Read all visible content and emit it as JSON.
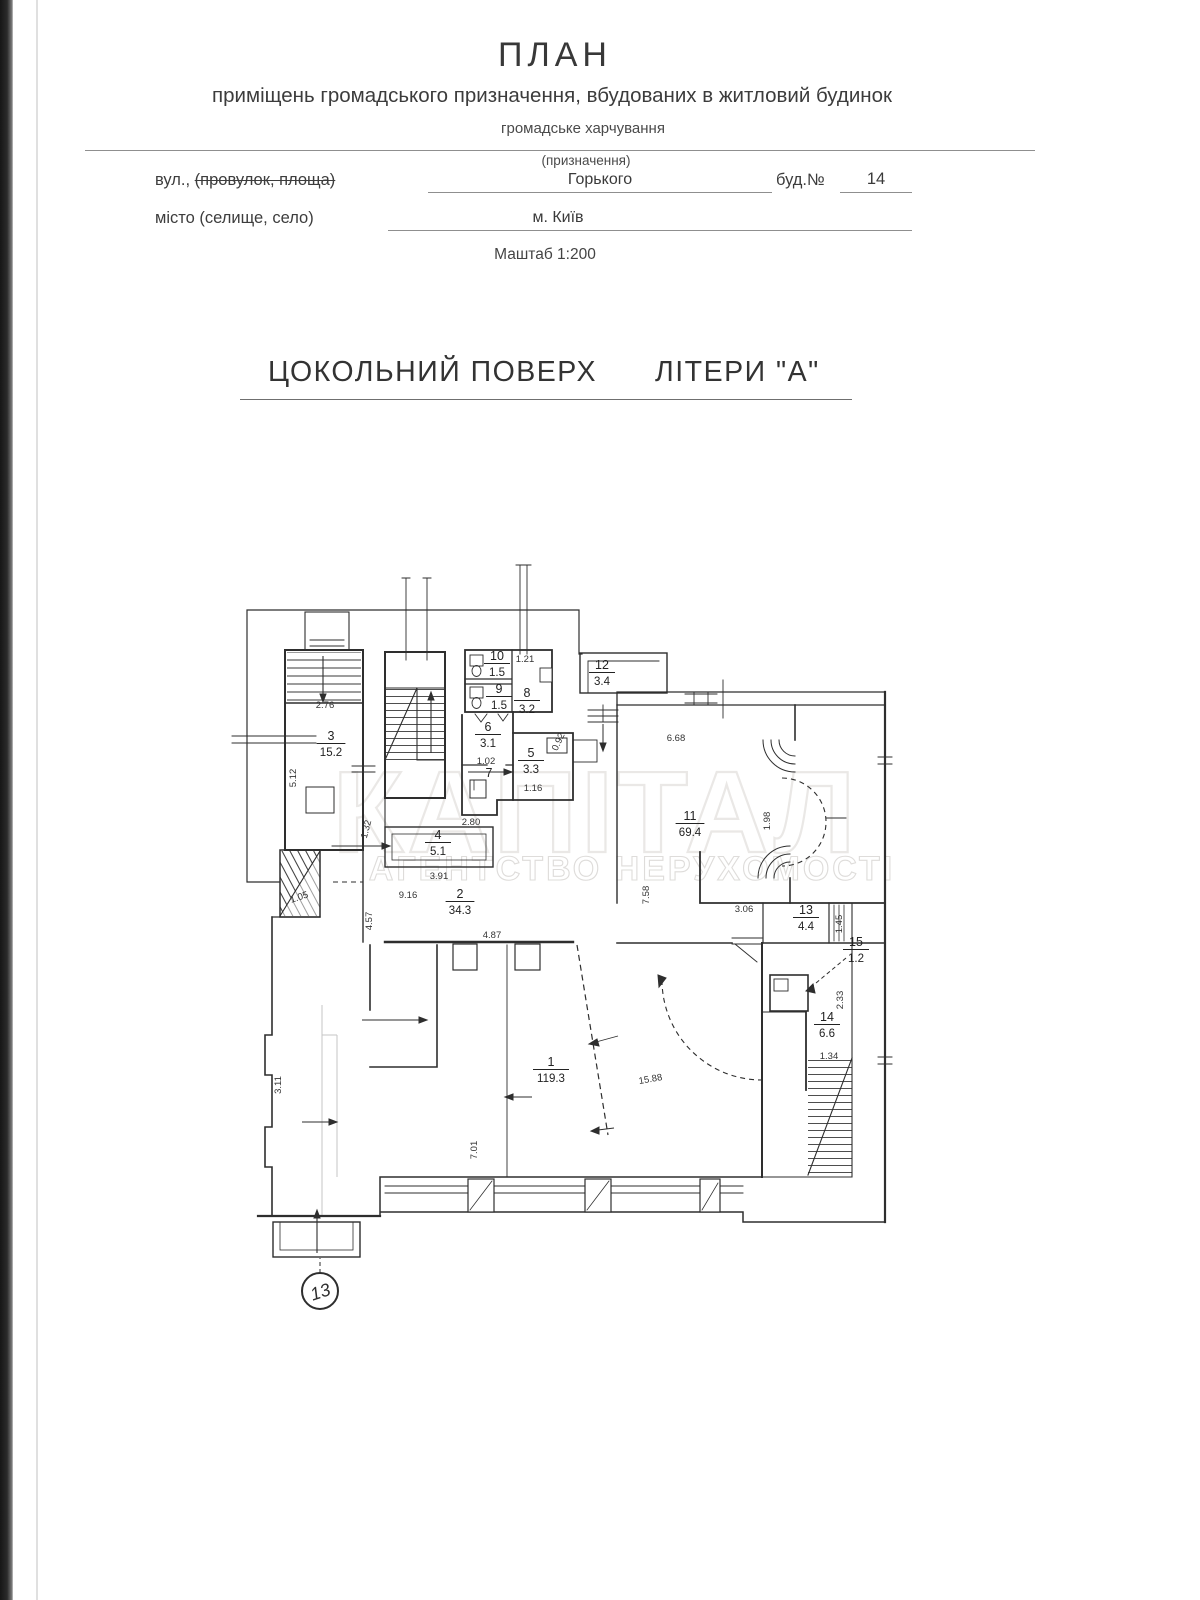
{
  "document": {
    "title": "ПЛАН",
    "subtitle": "приміщень громадського призначення, вбудованих в житловий будинок",
    "purpose_value": "громадське харчування",
    "purpose_caption": "(призначення)",
    "street_label_prefix": "вул., ",
    "street_label_struck": "(провулок, площа)",
    "street_value": "Горького",
    "building_label": "буд.№",
    "building_value": "14",
    "city_label": "місто (селище, село)",
    "city_value": "м. Київ",
    "scale_note": "Маштаб 1:200",
    "floor_title": "ЦОКОЛЬНИЙ ПОВЕРХ",
    "liter_title": "ЛІТЕРИ \"А\""
  },
  "watermark": {
    "brand": "КАПІТАЛ",
    "tagline": "АГЕНТСТВО НЕРУХОМОСТІ"
  },
  "plan": {
    "entry_marker": "13",
    "rooms": [
      {
        "number": "3",
        "area": "15.2",
        "x": 331,
        "y": 740
      },
      {
        "number": "10",
        "area": "1.5",
        "x": 497,
        "y": 660
      },
      {
        "number": "9",
        "area": "1.5",
        "x": 499,
        "y": 693
      },
      {
        "number": "8",
        "area": "3.2",
        "x": 527,
        "y": 697
      },
      {
        "number": "6",
        "area": "3.1",
        "x": 488,
        "y": 731
      },
      {
        "number": "7",
        "area": "",
        "x": 489,
        "y": 777
      },
      {
        "number": "5",
        "area": "3.3",
        "x": 531,
        "y": 757
      },
      {
        "number": "12",
        "area": "3.4",
        "x": 602,
        "y": 669
      },
      {
        "number": "4",
        "area": "5.1",
        "x": 438,
        "y": 839
      },
      {
        "number": "2",
        "area": "34.3",
        "x": 460,
        "y": 898
      },
      {
        "number": "11",
        "area": "69.4",
        "x": 690,
        "y": 820
      },
      {
        "number": "13",
        "area": "4.4",
        "x": 806,
        "y": 914
      },
      {
        "number": "15",
        "area": "1.2",
        "x": 856,
        "y": 946
      },
      {
        "number": "14",
        "area": "6.6",
        "x": 827,
        "y": 1021
      },
      {
        "number": "1",
        "area": "119.3",
        "x": 551,
        "y": 1066
      }
    ],
    "dimensions": [
      {
        "text": "2.76",
        "x": 325,
        "y": 708,
        "rot": 0
      },
      {
        "text": "5.12",
        "x": 296,
        "y": 778,
        "rot": -90
      },
      {
        "text": "1.05",
        "x": 300,
        "y": 900,
        "rot": -18
      },
      {
        "text": "1.21",
        "x": 525,
        "y": 662,
        "rot": 0
      },
      {
        "text": "0.92",
        "x": 561,
        "y": 743,
        "rot": -65
      },
      {
        "text": "1.02",
        "x": 486,
        "y": 764,
        "rot": 0
      },
      {
        "text": "1.16",
        "x": 533,
        "y": 791,
        "rot": 0
      },
      {
        "text": "1.32",
        "x": 369,
        "y": 830,
        "rot": -75
      },
      {
        "text": "2.80",
        "x": 471,
        "y": 825,
        "rot": 0
      },
      {
        "text": "3.91",
        "x": 439,
        "y": 879,
        "rot": 0
      },
      {
        "text": "9.16",
        "x": 408,
        "y": 898,
        "rot": 0
      },
      {
        "text": "4.57",
        "x": 372,
        "y": 921,
        "rot": -90
      },
      {
        "text": "4.87",
        "x": 492,
        "y": 938,
        "rot": 0
      },
      {
        "text": "7.58",
        "x": 649,
        "y": 895,
        "rot": -90
      },
      {
        "text": "6.68",
        "x": 676,
        "y": 741,
        "rot": 0
      },
      {
        "text": "1.98",
        "x": 770,
        "y": 821,
        "rot": -90
      },
      {
        "text": "3.06",
        "x": 744,
        "y": 912,
        "rot": 0
      },
      {
        "text": "1.45",
        "x": 842,
        "y": 924,
        "rot": -90
      },
      {
        "text": "2.33",
        "x": 843,
        "y": 1000,
        "rot": -90
      },
      {
        "text": "1.34",
        "x": 829,
        "y": 1059,
        "rot": 0
      },
      {
        "text": "15.88",
        "x": 651,
        "y": 1082,
        "rot": -10
      },
      {
        "text": "7.01",
        "x": 477,
        "y": 1150,
        "rot": -90
      },
      {
        "text": "3.11",
        "x": 281,
        "y": 1085,
        "rot": -90
      }
    ]
  }
}
